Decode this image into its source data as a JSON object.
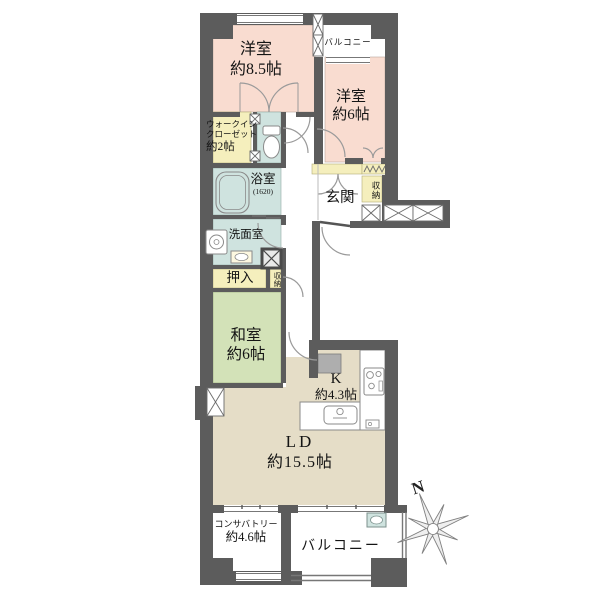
{
  "rooms": {
    "bedroom1": {
      "label": "洋室",
      "size": "約8.5帖"
    },
    "balcony_top": {
      "label": "バルコニー"
    },
    "bedroom2": {
      "label": "洋室",
      "size": "約6帖"
    },
    "walk_in_closet": {
      "line1": "ウォークイン",
      "line2": "クローゼット",
      "size": "約2帖"
    },
    "bathroom": {
      "label": "浴室",
      "size": "(1620)"
    },
    "entrance": {
      "label": "玄関"
    },
    "entrance_storage": {
      "label": "収納"
    },
    "washroom": {
      "label": "洗面室"
    },
    "futon_closet": {
      "label": "押入"
    },
    "hall_storage": {
      "label": "収納"
    },
    "japanese_room": {
      "label": "和室",
      "size": "約6帖"
    },
    "kitchen": {
      "label": "K",
      "size": "約4.3帖"
    },
    "living_dining": {
      "label": "LD",
      "size": "約15.5帖"
    },
    "conservatory": {
      "label": "コンサバトリー",
      "size": "約4.6帖"
    },
    "balcony_bottom": {
      "label": "バルコニー"
    }
  },
  "compass": {
    "north_label": "N"
  },
  "colors": {
    "wall": "#5c5c5c",
    "bedroom_pink": "#f9dcd0",
    "tatami_green": "#d3e2b8",
    "living_beige": "#e5ddc7",
    "closet_yellow": "#f5efbd",
    "wet_area_blue": "#cfe3df",
    "outline_gray": "#8a8a8a"
  }
}
